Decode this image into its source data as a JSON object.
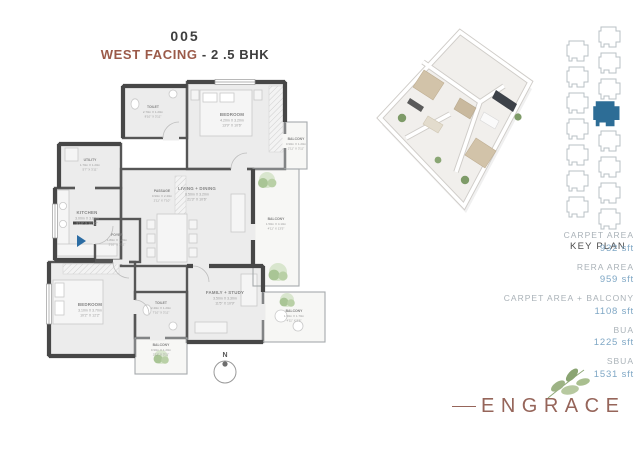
{
  "title": {
    "unit_number": "005",
    "facing": "WEST FACING",
    "type_suffix": "- 2 .5 BHK"
  },
  "floor_plan": {
    "north_label": "N",
    "rooms": [
      {
        "name": "TOILET",
        "dim_m": "2.70m X 1.20m",
        "dim_ft": "8'10\" X 3'11\""
      },
      {
        "name": "BEDROOM",
        "dim_m": "4.20m X 3.20m",
        "dim_ft": "13'9\" X 10'6\""
      },
      {
        "name": "BALCONY",
        "dim_m": "0.90m X 1.20m",
        "dim_ft": "2'11\" X 3'11\""
      },
      {
        "name": "UTILITY",
        "dim_m": "1.70m X 1.20m",
        "dim_ft": "5'7\" X 3'11\""
      },
      {
        "name": "PASSAGE",
        "dim_m": "0.90m X 2.40m",
        "dim_ft": "2'11\" X 7'10\""
      },
      {
        "name": "KITCHEN",
        "dim_m": "3.00m X 3.60m",
        "dim_ft": "9'10\" X 11'10\""
      },
      {
        "name": "LIVING + DINING",
        "dim_m": "6.50m X 3.20m",
        "dim_ft": "21'3\" X 10'6\""
      },
      {
        "name": "BALCONY",
        "dim_m": "1.50m X 4.10m",
        "dim_ft": "4'11\" X 13'5\""
      },
      {
        "name": "FOYER",
        "dim_m": "1.80m X 1.20m",
        "dim_ft": "5'10\" X 3'11\""
      },
      {
        "name": "BEDROOM",
        "dim_m": "3.10m X 3.70m",
        "dim_ft": "10'2\" X 12'2\""
      },
      {
        "name": "TOILET",
        "dim_m": "2.40m X 1.20m",
        "dim_ft": "7'10\" X 3'11\""
      },
      {
        "name": "BALCONY",
        "dim_m": "0.90m X 1.20m",
        "dim_ft": "2'11\" X 3'11\""
      },
      {
        "name": "FAMILY + STUDY",
        "dim_m": "3.50m X 3.30m",
        "dim_ft": "11'5\" X 10'9\""
      },
      {
        "name": "BALCONY",
        "dim_m": "1.50m X 1.70m",
        "dim_ft": "4'11\" X 5'6\""
      }
    ]
  },
  "key_plan": {
    "label": "KEY PLAN"
  },
  "areas": {
    "items": [
      {
        "label": "CARPET AREA",
        "value": "932 sft"
      },
      {
        "label": "RERA AREA",
        "value": "959 sft"
      },
      {
        "label": "CARPET AREA + BALCONY",
        "value": "1108 sft"
      },
      {
        "label": "BUA",
        "value": "1225 sft"
      },
      {
        "label": "SBUA",
        "value": "1531 sft"
      }
    ]
  },
  "brand": {
    "name": "ENGRACE"
  },
  "colors": {
    "accent_terracotta": "#9b5a49",
    "keyplan_highlight": "#2d6d96",
    "area_value_blue": "#7fa7c5",
    "plan_wall": "#4a4a4a",
    "plant_green": "#a9c595",
    "entry_arrow_blue": "#2b6ca3",
    "brand_mauve": "#96655a"
  }
}
